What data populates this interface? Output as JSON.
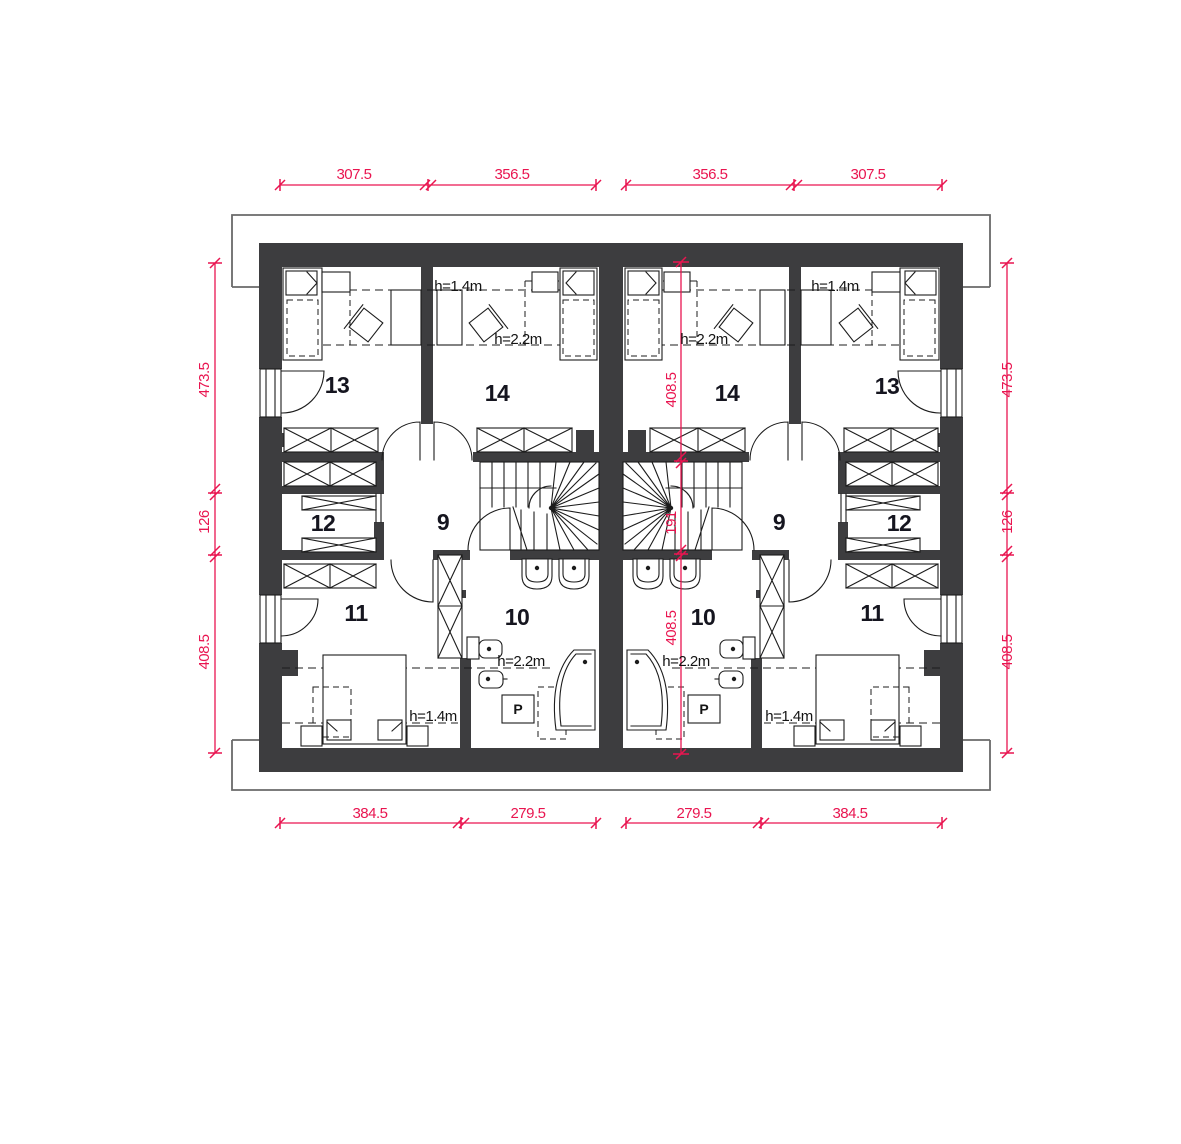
{
  "colors": {
    "dimension_red": "#e91550",
    "wall_dark": "#3d3d3f"
  },
  "dimensions": {
    "top": [
      "307.5",
      "356.5",
      "356.5",
      "307.5"
    ],
    "bottom": [
      "384.5",
      "279.5",
      "279.5",
      "384.5"
    ],
    "left": [
      "473.5",
      "126",
      "408.5"
    ],
    "right": [
      "473.5",
      "126",
      "408.5"
    ],
    "center": [
      "408.5",
      "191",
      "408.5"
    ]
  },
  "room_numbers": {
    "room_9": "9",
    "room_10": "10",
    "room_11": "11",
    "room_12": "12",
    "room_13": "13",
    "room_14": "14"
  },
  "heights": {
    "h_14": "h=1.4m",
    "h_22": "h=2.2m"
  },
  "labels": {
    "washing_machine": "P"
  }
}
